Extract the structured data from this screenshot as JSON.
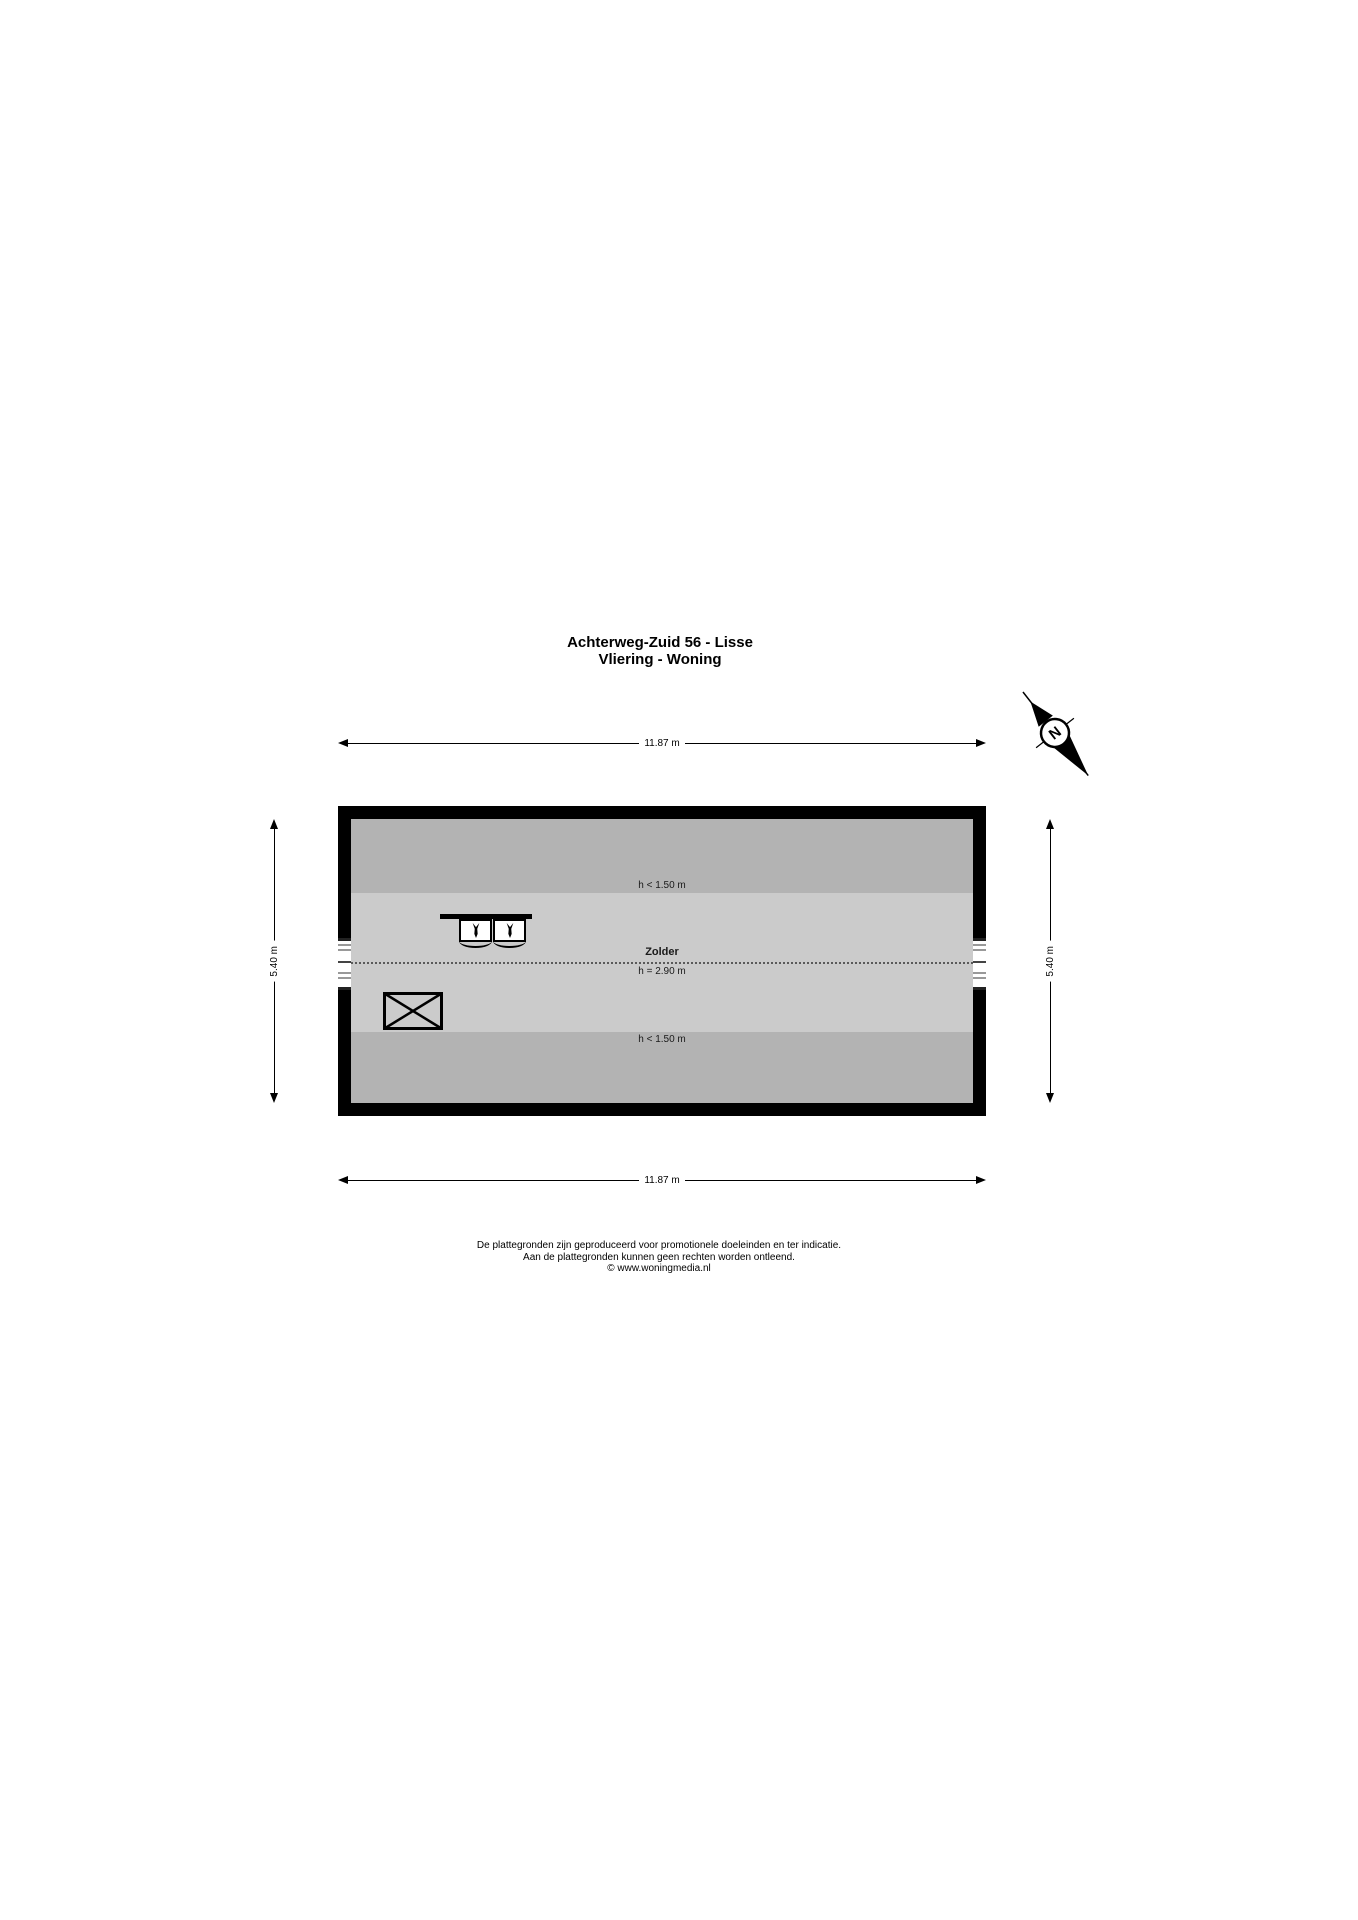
{
  "title": {
    "line1": "Achterweg-Zuid 56 - Lisse",
    "line2": "Vliering - Woning"
  },
  "compass": {
    "label": "N"
  },
  "dimensions": {
    "top": "11.87 m",
    "bottom": "11.87 m",
    "left": "5.40 m",
    "right": "5.40 m"
  },
  "floorplan": {
    "room_label": "Zolder",
    "ridge_height_label": "h = 2.90 m",
    "low_height_top": "h < 1.50 m",
    "low_height_bottom": "h < 1.50 m",
    "colors": {
      "wall": "#000000",
      "low_band": "#b3b3b3",
      "main_band": "#cbcbcb",
      "paper": "#ffffff"
    }
  },
  "footer": {
    "lines": [
      "De plattegronden zijn geproduceerd voor promotionele doeleinden en ter indicatie.",
      "Aan de plattegronden kunnen geen rechten worden ontleend.",
      "© www.woningmedia.nl"
    ]
  }
}
